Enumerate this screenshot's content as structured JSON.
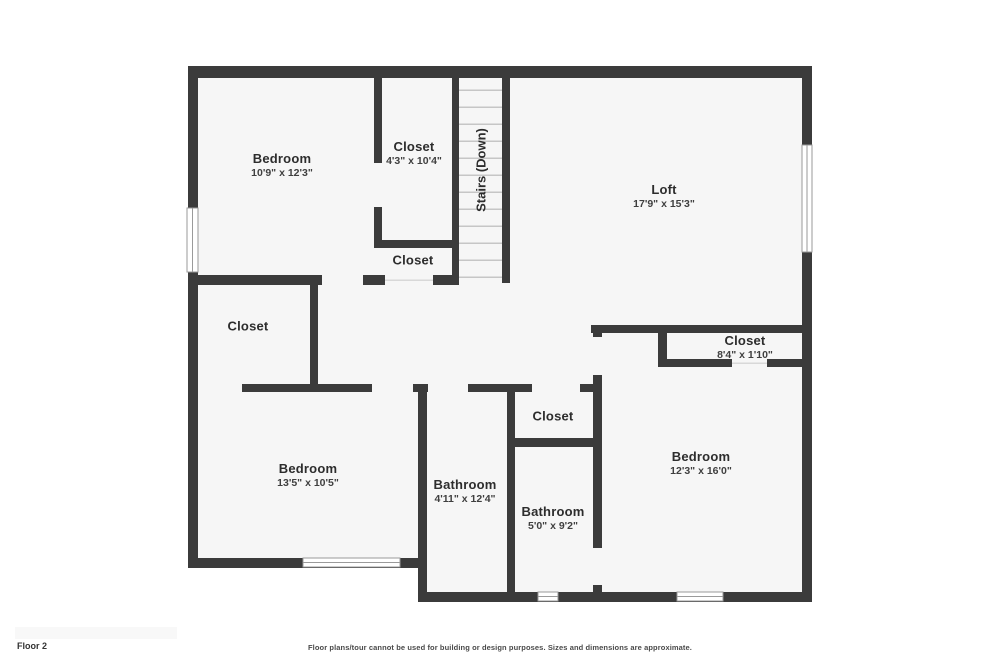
{
  "colors": {
    "wall": "#3b3b3b",
    "floor": "#f6f6f6",
    "tread": "#c6c6c6",
    "label": "#2d2d2d",
    "dims": "#3f3f3f",
    "winline": "#9a9a9a",
    "footerbox": "#f8f8f8",
    "footertext": "#4a4a4a"
  },
  "rooms": [
    {
      "name": "Bedroom",
      "dims": "10'9\" x 12'3\""
    },
    {
      "name": "Closet",
      "dims": "4'3\" x 10'4\""
    },
    {
      "name": "Loft",
      "dims": "17'9\" x 15'3\""
    },
    {
      "name": "Closet"
    },
    {
      "name": "Closet"
    },
    {
      "name": "Closet",
      "dims": "8'4\" x 1'10\""
    },
    {
      "name": "Bedroom",
      "dims": "13'5\" x 10'5\""
    },
    {
      "name": "Bathroom",
      "dims": "4'11\" x 12'4\""
    },
    {
      "name": "Closet"
    },
    {
      "name": "Bathroom",
      "dims": "5'0\" x 9'2\""
    },
    {
      "name": "Bedroom",
      "dims": "12'3\" x 16'0\""
    }
  ],
  "stairs": {
    "label": "Stairs (Down)"
  },
  "footer": {
    "floor_label": "Floor 2",
    "disclaimer": "Floor plans/tour cannot be used for building or design purposes. Sizes and dimensions are approximate."
  }
}
